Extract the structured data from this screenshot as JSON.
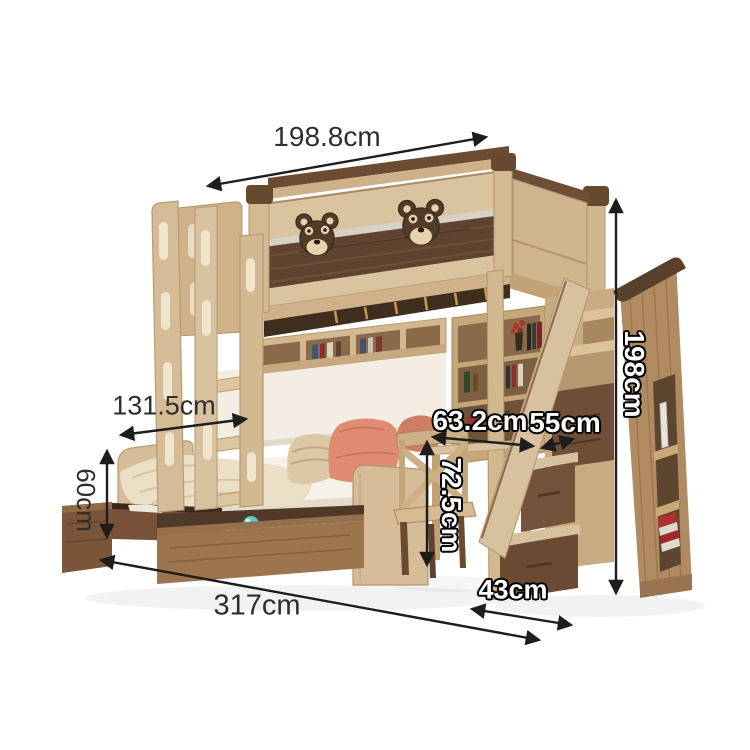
{
  "page": {
    "background": "#ffffff",
    "type": "product dimension illustration"
  },
  "product": {
    "name": "Kids bunk bed with storage staircase, desk, bookshelves and under-bed drawers",
    "features": [
      "upper bunk with guard rail",
      "teddy bear decorations",
      "side ladder",
      "hanging bookshelf",
      "lower bed with pillows",
      "pull-out under-bed drawers",
      "study desk with cross-back chair",
      "storage staircase with drawers",
      "tall side cabinet with book niche"
    ],
    "palette": {
      "wood_light": "#d9c49f",
      "wood_mid": "#c0a277",
      "walnut": "#6b4a32",
      "walnut_dark": "#4b3523",
      "accent_stripe": "#d6d2c8",
      "bedding_white": "#f6f2ea",
      "wall_panel": "#f3ede3",
      "pillow_salmon": "#e08c72",
      "pillow_patterned": "#dcc8a6",
      "blanket_cream": "#ebdfc6",
      "toy_ball_teal": "#5cc6ba",
      "bear_brown": "#543a28",
      "bear_muzzle": "#e5d3ae"
    }
  },
  "annotations": {
    "arrow_color": "#1d1d1d",
    "labels": [
      {
        "id": "overall-width-top",
        "text": "198.8cm",
        "style": "plain",
        "rotated": false
      },
      {
        "id": "lower-bed-width",
        "text": "131.5cm",
        "style": "plain",
        "rotated": false
      },
      {
        "id": "drawer-height",
        "text": "60cm",
        "style": "plain",
        "rotated": true
      },
      {
        "id": "overall-length-floor",
        "text": "317cm",
        "style": "plain",
        "rotated": false
      },
      {
        "id": "desk-area-width",
        "text": "63.2cm",
        "style": "outline",
        "rotated": false
      },
      {
        "id": "staircase-width",
        "text": "55cm",
        "style": "outline",
        "rotated": false
      },
      {
        "id": "desk-height",
        "text": "72.5cm",
        "style": "outline",
        "rotated": true
      },
      {
        "id": "stair-drawer-width",
        "text": "43cm",
        "style": "outline",
        "rotated": false
      },
      {
        "id": "overall-height",
        "text": "198cm",
        "style": "outline",
        "rotated": true
      }
    ]
  }
}
